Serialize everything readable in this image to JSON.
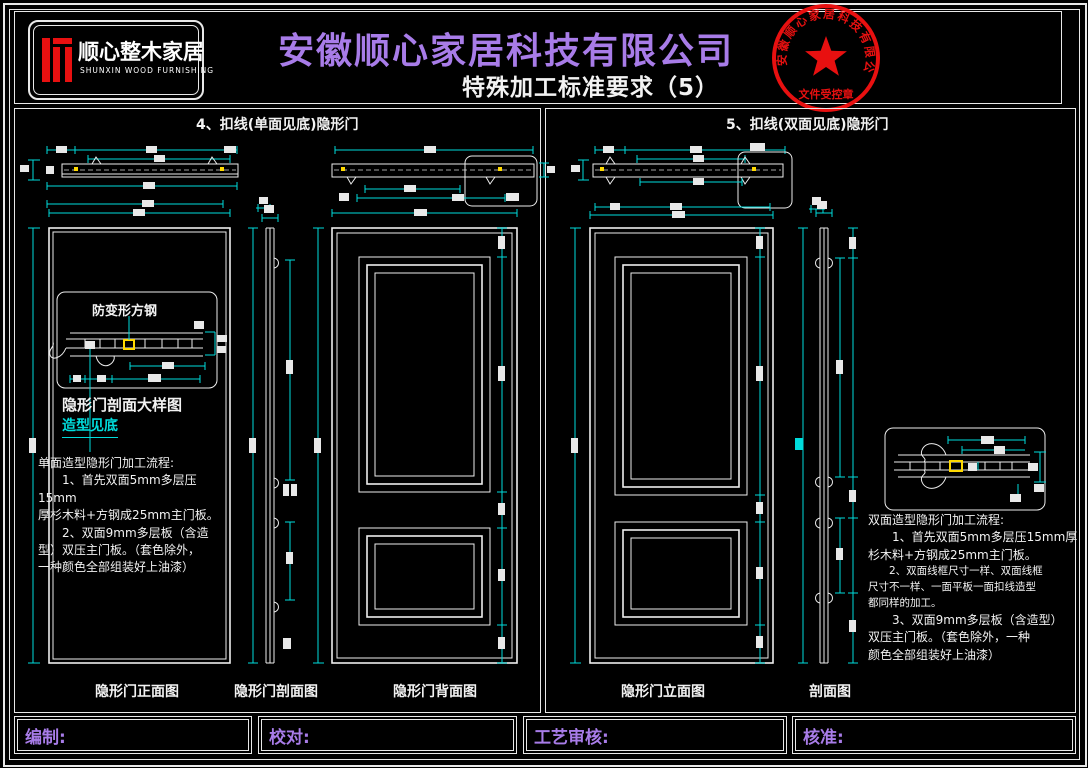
{
  "header": {
    "logo": {
      "brand": "顺心整木家居",
      "brand_en": "SHUNXIN WOOD FURNISHING"
    },
    "title": "安徽顺心家居科技有限公司",
    "subtitle": "特殊加工标准要求（5）",
    "stamp": {
      "ring_text": "安徽顺心家居科技有限公司",
      "center_label": "文件受控章"
    }
  },
  "left_panel": {
    "title": "4、扣线(单面见底)隐形门",
    "detail": {
      "callout_label": "防变形方钢",
      "detail_title": "隐形门剖面大样图",
      "detail_note": "造型见底"
    },
    "process_text": "单面造型隐形门加工流程:\n　　1、首先双面5mm多层压15mm\n厚杉木料+方钢成25mm主门板。\n　　2、双面9mm多层板（含造\n型）双压主门板。（套色除外，\n一种颜色全部组装好上油漆）",
    "view_labels": [
      "隐形门正面图",
      "隐形门剖面图",
      "隐形门背面图"
    ]
  },
  "right_panel": {
    "title": "5、扣线(双面见底)隐形门",
    "proc1": "双面造型隐形门加工流程:\n　　1、首先双面5mm多层压15mm厚\n杉木料+方钢成25mm主门板。",
    "proc2": "　　2、双面线框尺寸一样、双面线框\n尺寸不一样、一面平板一面扣线造型\n都同样的加工。",
    "proc3": "　　3、双面9mm多层板（含造型）\n双压主门板。（套色除外，一种\n颜色全部组装好上油漆）",
    "view_labels": [
      "隐形门立面图",
      "剖面图"
    ]
  },
  "footer": {
    "fields": [
      "编制:",
      "校对:",
      "工艺审核:",
      "核准:"
    ]
  },
  "colors": {
    "background": "#000000",
    "line": "#ededed",
    "dimension_cyan": "#00dcdc",
    "accent_purple": "#a87ce8",
    "stamp_red": "#e81010",
    "steel_marker_yellow": "#ffd900"
  }
}
